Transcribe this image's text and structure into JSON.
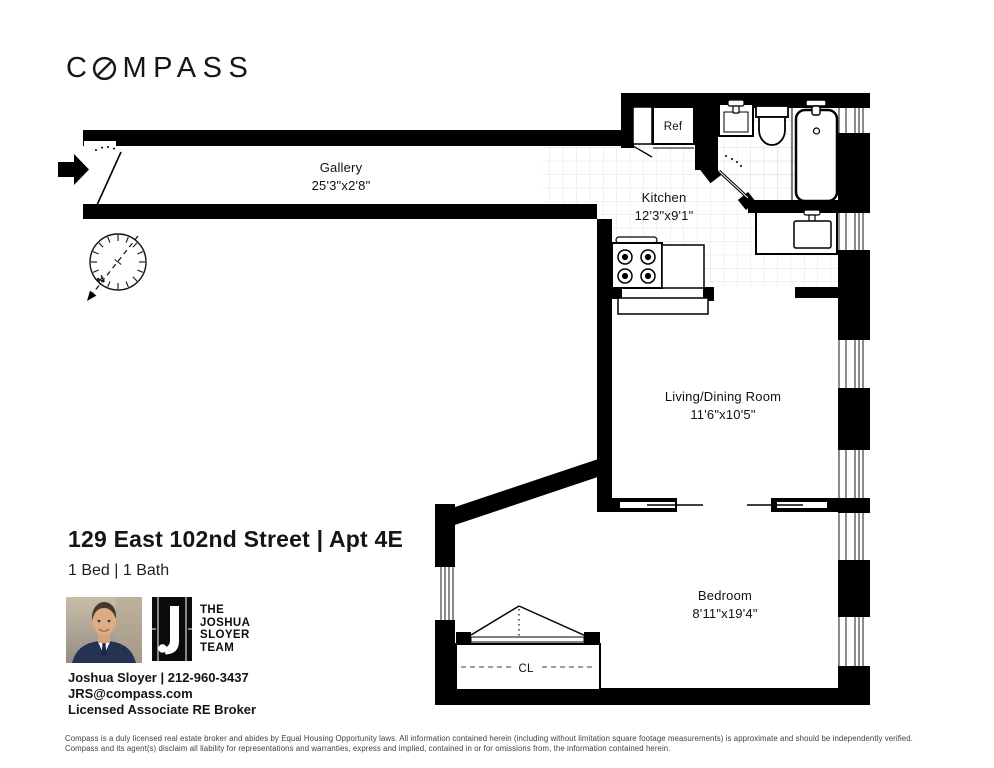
{
  "brand": {
    "name": "COMPASS",
    "logo_left": "C",
    "logo_right": "MPASS"
  },
  "listing": {
    "title": "129 East 102nd Street | Apt 4E",
    "beds_baths": "1 Bed | 1 Bath"
  },
  "agent": {
    "name_phone": "Joshua Sloyer | 212-960-3437",
    "email": "JRS@compass.com",
    "license": "Licensed Associate RE Broker"
  },
  "team_logo": {
    "line1": "THE",
    "line2": "JOSHUA",
    "line3": "SLOYER",
    "line4": "TEAM"
  },
  "floorplan": {
    "rooms": {
      "gallery": {
        "name": "Gallery",
        "dims": "25'3\"x2'8\""
      },
      "kitchen": {
        "name": "Kitchen",
        "dims": "12'3\"x9'1\""
      },
      "living": {
        "name": "Living/Dining Room",
        "dims": "11'6\"x10'5\""
      },
      "bedroom": {
        "name": "Bedroom",
        "dims": "8'11\"x19'4\""
      }
    },
    "labels": {
      "refrigerator": "Ref",
      "closet": "CL",
      "north": "N"
    }
  },
  "disclaimer": {
    "line1": "Compass is a duly licensed real estate broker and abides by Equal Housing Opportunity laws.  All information contained herein (including without limitation square footage measurements) is approximate and should be independently verified.",
    "line2": "Compass and its agent(s) disclaim all liability for representations and warranties, express and implied, contained in or for omissions from, the information contained herein."
  }
}
